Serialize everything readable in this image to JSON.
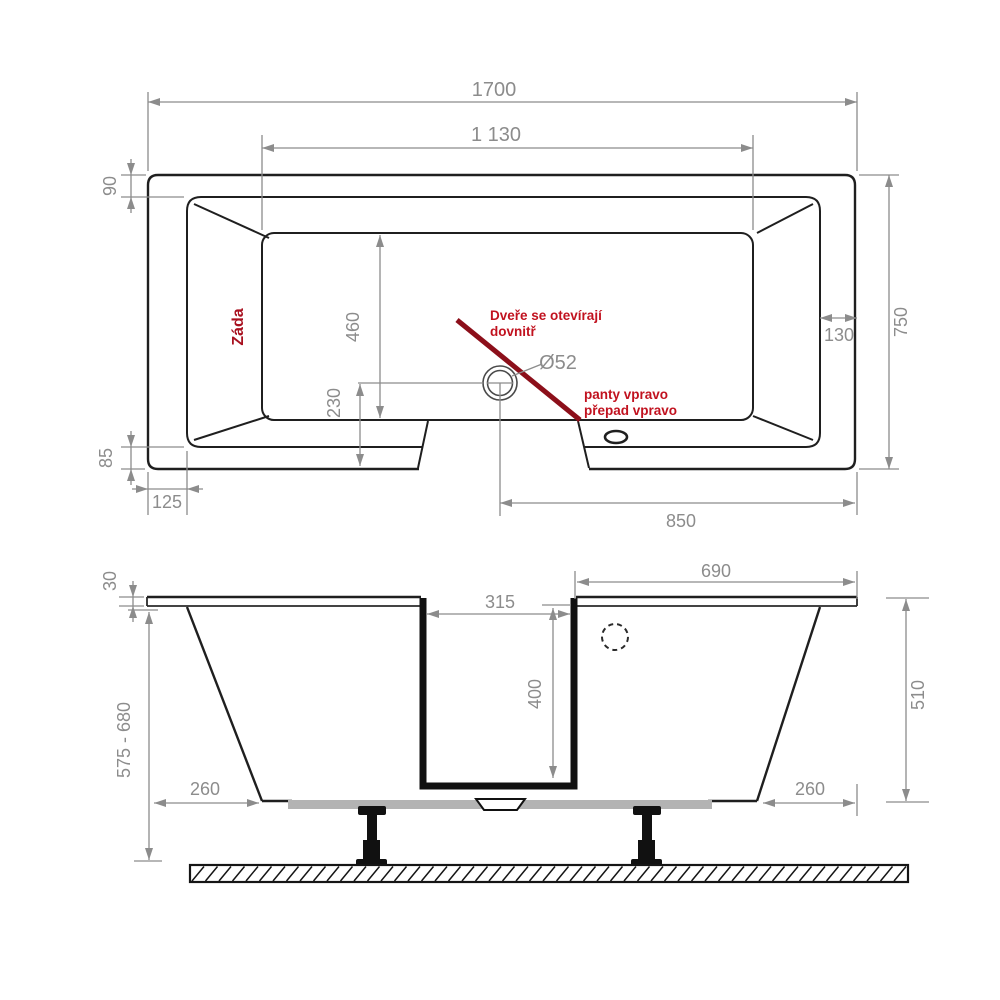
{
  "drawing": {
    "title": "bathtub-technical-drawing",
    "colors": {
      "line_black": "#1f1f1f",
      "dimension_gray": "#8c8c8c",
      "annotation_red": "#c1121f",
      "door_swing_red": "#8c0f1a",
      "base_gray": "#b3b3b3"
    },
    "top_view": {
      "dims": {
        "overall_length": "1700",
        "basin_length": "1 130",
        "rim_back": "90",
        "overall_width": "750",
        "rim_right": "130",
        "basin_width": "460",
        "drain_to_front": "230",
        "rim_front": "85",
        "rim_front_left": "125",
        "door_to_right_edge": "850",
        "drain_diameter": "Ø52"
      },
      "labels": {
        "back": "Záda",
        "door_note_1": "Dveře se otevírají",
        "door_note_2": "dovnitř",
        "hinge_note_1": "panty vpravo",
        "hinge_note_2": "přepad vpravo"
      }
    },
    "front_view": {
      "dims": {
        "apron_top_thickness": "30",
        "height_range": "575 - 680",
        "left_inset": "260",
        "door_opening_width": "315",
        "door_opening_depth": "400",
        "top_right_length": "690",
        "body_height": "510",
        "right_inset": "260"
      }
    }
  }
}
